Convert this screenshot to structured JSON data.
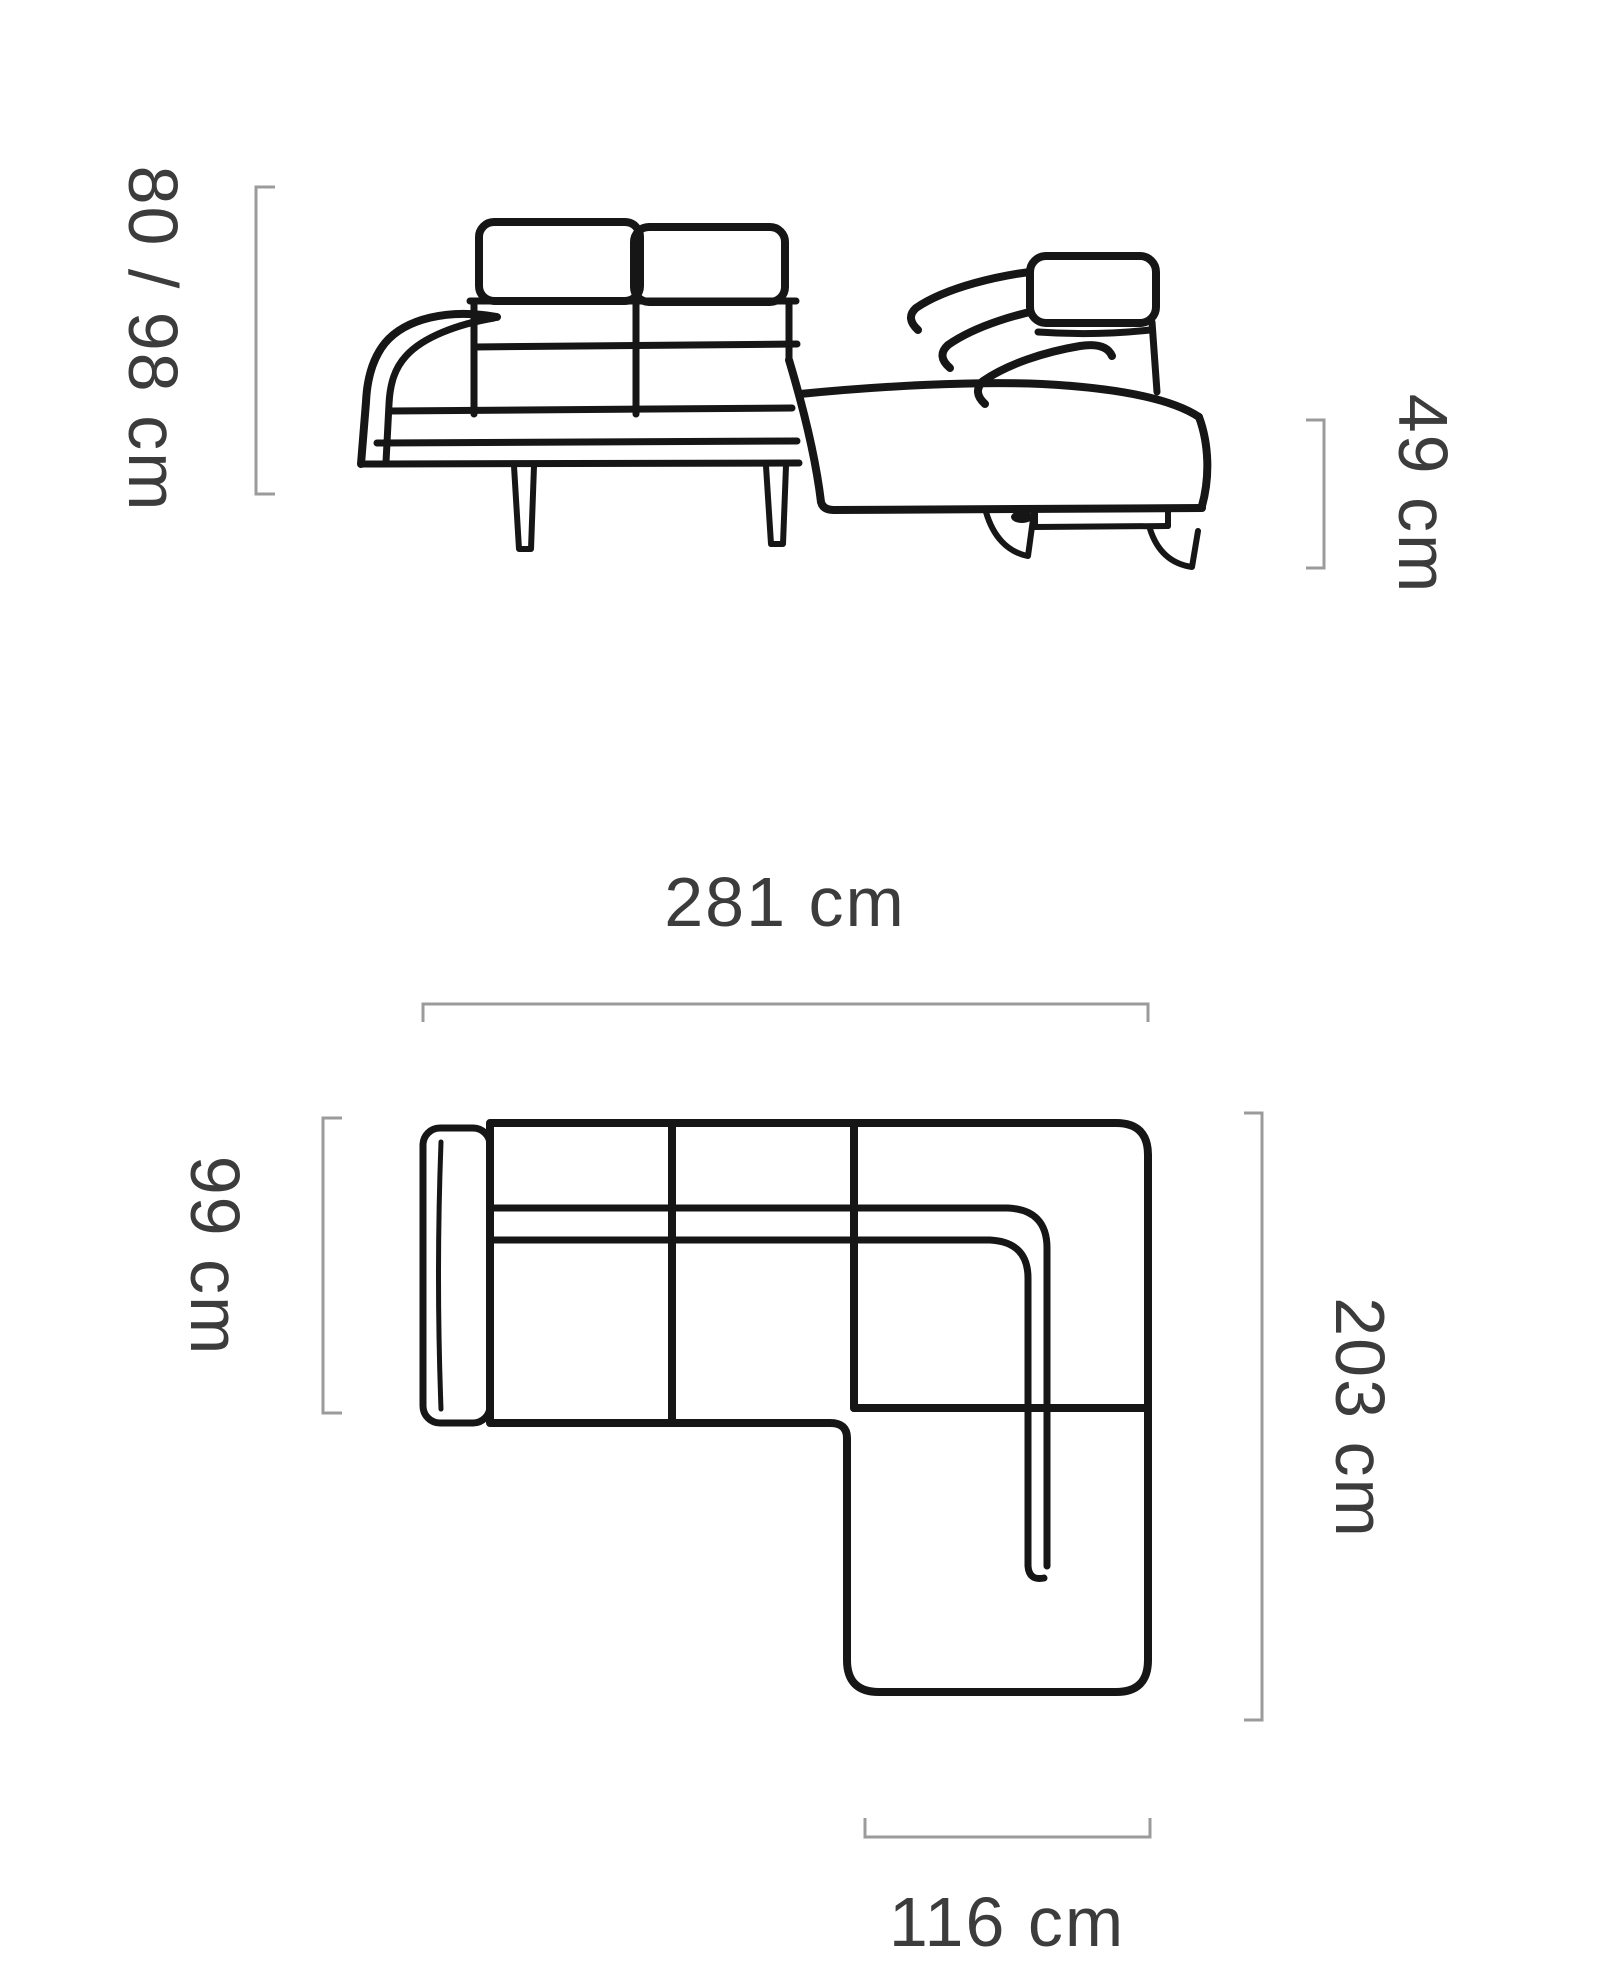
{
  "title": "Corner sofa dimensions diagram",
  "front_view": {
    "labels": {
      "height": "80 / 98 cm",
      "seat_height": "49 cm"
    }
  },
  "top_view": {
    "labels": {
      "width": "281 cm",
      "depth": "99 cm",
      "side": "203 cm",
      "chaise": "116 cm"
    }
  },
  "colors": {
    "line": "#161616",
    "bracket": "#9b9b9b",
    "text": "#3c3c3c",
    "background": "#ffffff"
  }
}
